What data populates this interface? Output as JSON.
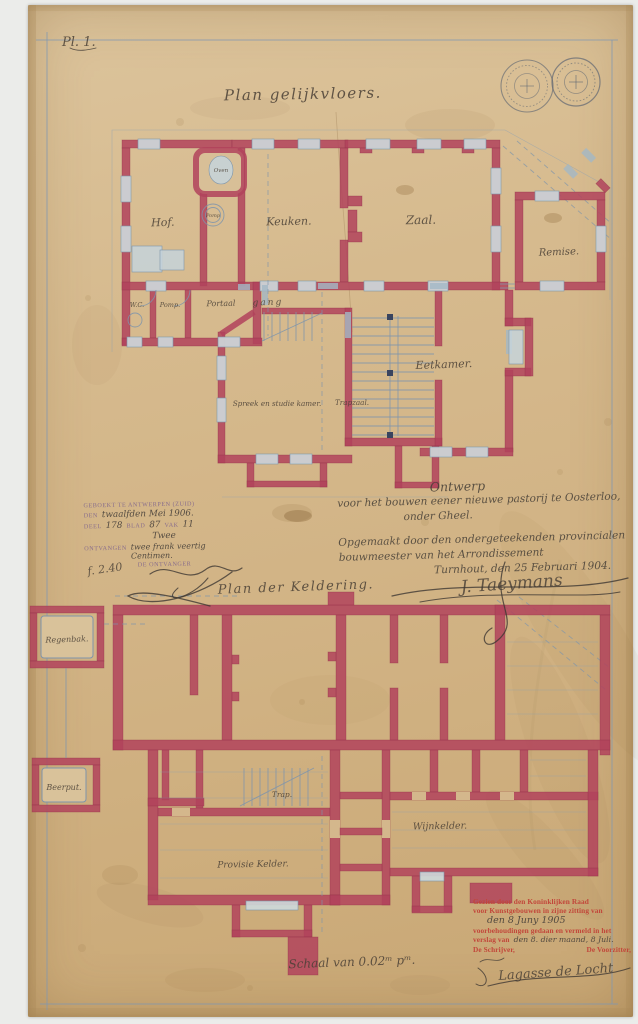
{
  "page": {
    "plate_label": "Pl. 1.",
    "scale_note": "Schaal van 0.02ᵐ pᵐ."
  },
  "ground_floor": {
    "title": "Plan gelijkvloers.",
    "rooms": {
      "hof": "Hof.",
      "oven": "Oven",
      "pomp_scullery": "Pomp",
      "keuken": "Keuken.",
      "zaal": "Zaal.",
      "remise": "Remise.",
      "wc": "W.C.",
      "pomp": "Pomp.",
      "portaal": "Portaal",
      "gang": "gang",
      "eetkamer": "Eetkamer.",
      "spreek_studiekamer": "Spreek en studie kamer.",
      "trapzaal": "Trapzaal."
    }
  },
  "cellar": {
    "title": "Plan der Keldering.",
    "rooms": {
      "trap": "Trap.",
      "provisie_kelder": "Provisie Kelder.",
      "wijnkelder": "Wijnkelder.",
      "regenbak": "Regenbak.",
      "beerput": "Beerput."
    }
  },
  "registration_stamp": {
    "line1": "GEBOEKT TE ANTWERPEN (ZUID)",
    "row2": {
      "label": "DEN",
      "value": "twaalfden Mei 1906."
    },
    "row3": {
      "l1": "DEEL",
      "v1": "178",
      "l2": "BLAD",
      "v2": "87",
      "l3": "VAK",
      "v3": "11"
    },
    "row4": {
      "value": "Twee"
    },
    "row5": {
      "label": "ONTVANGEN",
      "value": "twee frank veertig Centimen."
    },
    "line6": "DE ONTVANGER",
    "fee": "f. 2.40"
  },
  "design_note": {
    "line1": "Ontwerp",
    "line2": "voor het bouwen eener nieuwe pastorij te Oosterloo,",
    "line3": "onder Gheel.",
    "line4": "Opgemaakt door den ondergeteekenden provincialen",
    "line5": "bouwmeester van het Arrondissement",
    "line6": "Turnhout, den 25 Februari 1904.",
    "signature": "J. Taeymans"
  },
  "approval_stamp": {
    "line1": "Gezien door den Koninklijken Raad",
    "line2": "voor Kunstgebouwen in zijne zitting van",
    "date": "den 8 Juny 1905",
    "line4": "voorbehoudingen gedaan en vermeld in het",
    "line5_label": "verslag van",
    "line5_value": "den 8. dier maand, 8 Juli.",
    "left_title": "De Schrijver,",
    "right_title": "De Voorzitter,",
    "signature": "Lagasse de Locht"
  },
  "icons": {
    "seal_left": "circular-ink-seal",
    "seal_right": "circular-ink-seal"
  },
  "colors": {
    "paper": "#d5b88d",
    "wall_red": "#b2435c",
    "detail_blue": "#7e94ab",
    "ink": "#4a4138",
    "stamp_purple": "#9b82a6",
    "stamp_red": "#c2463a"
  }
}
